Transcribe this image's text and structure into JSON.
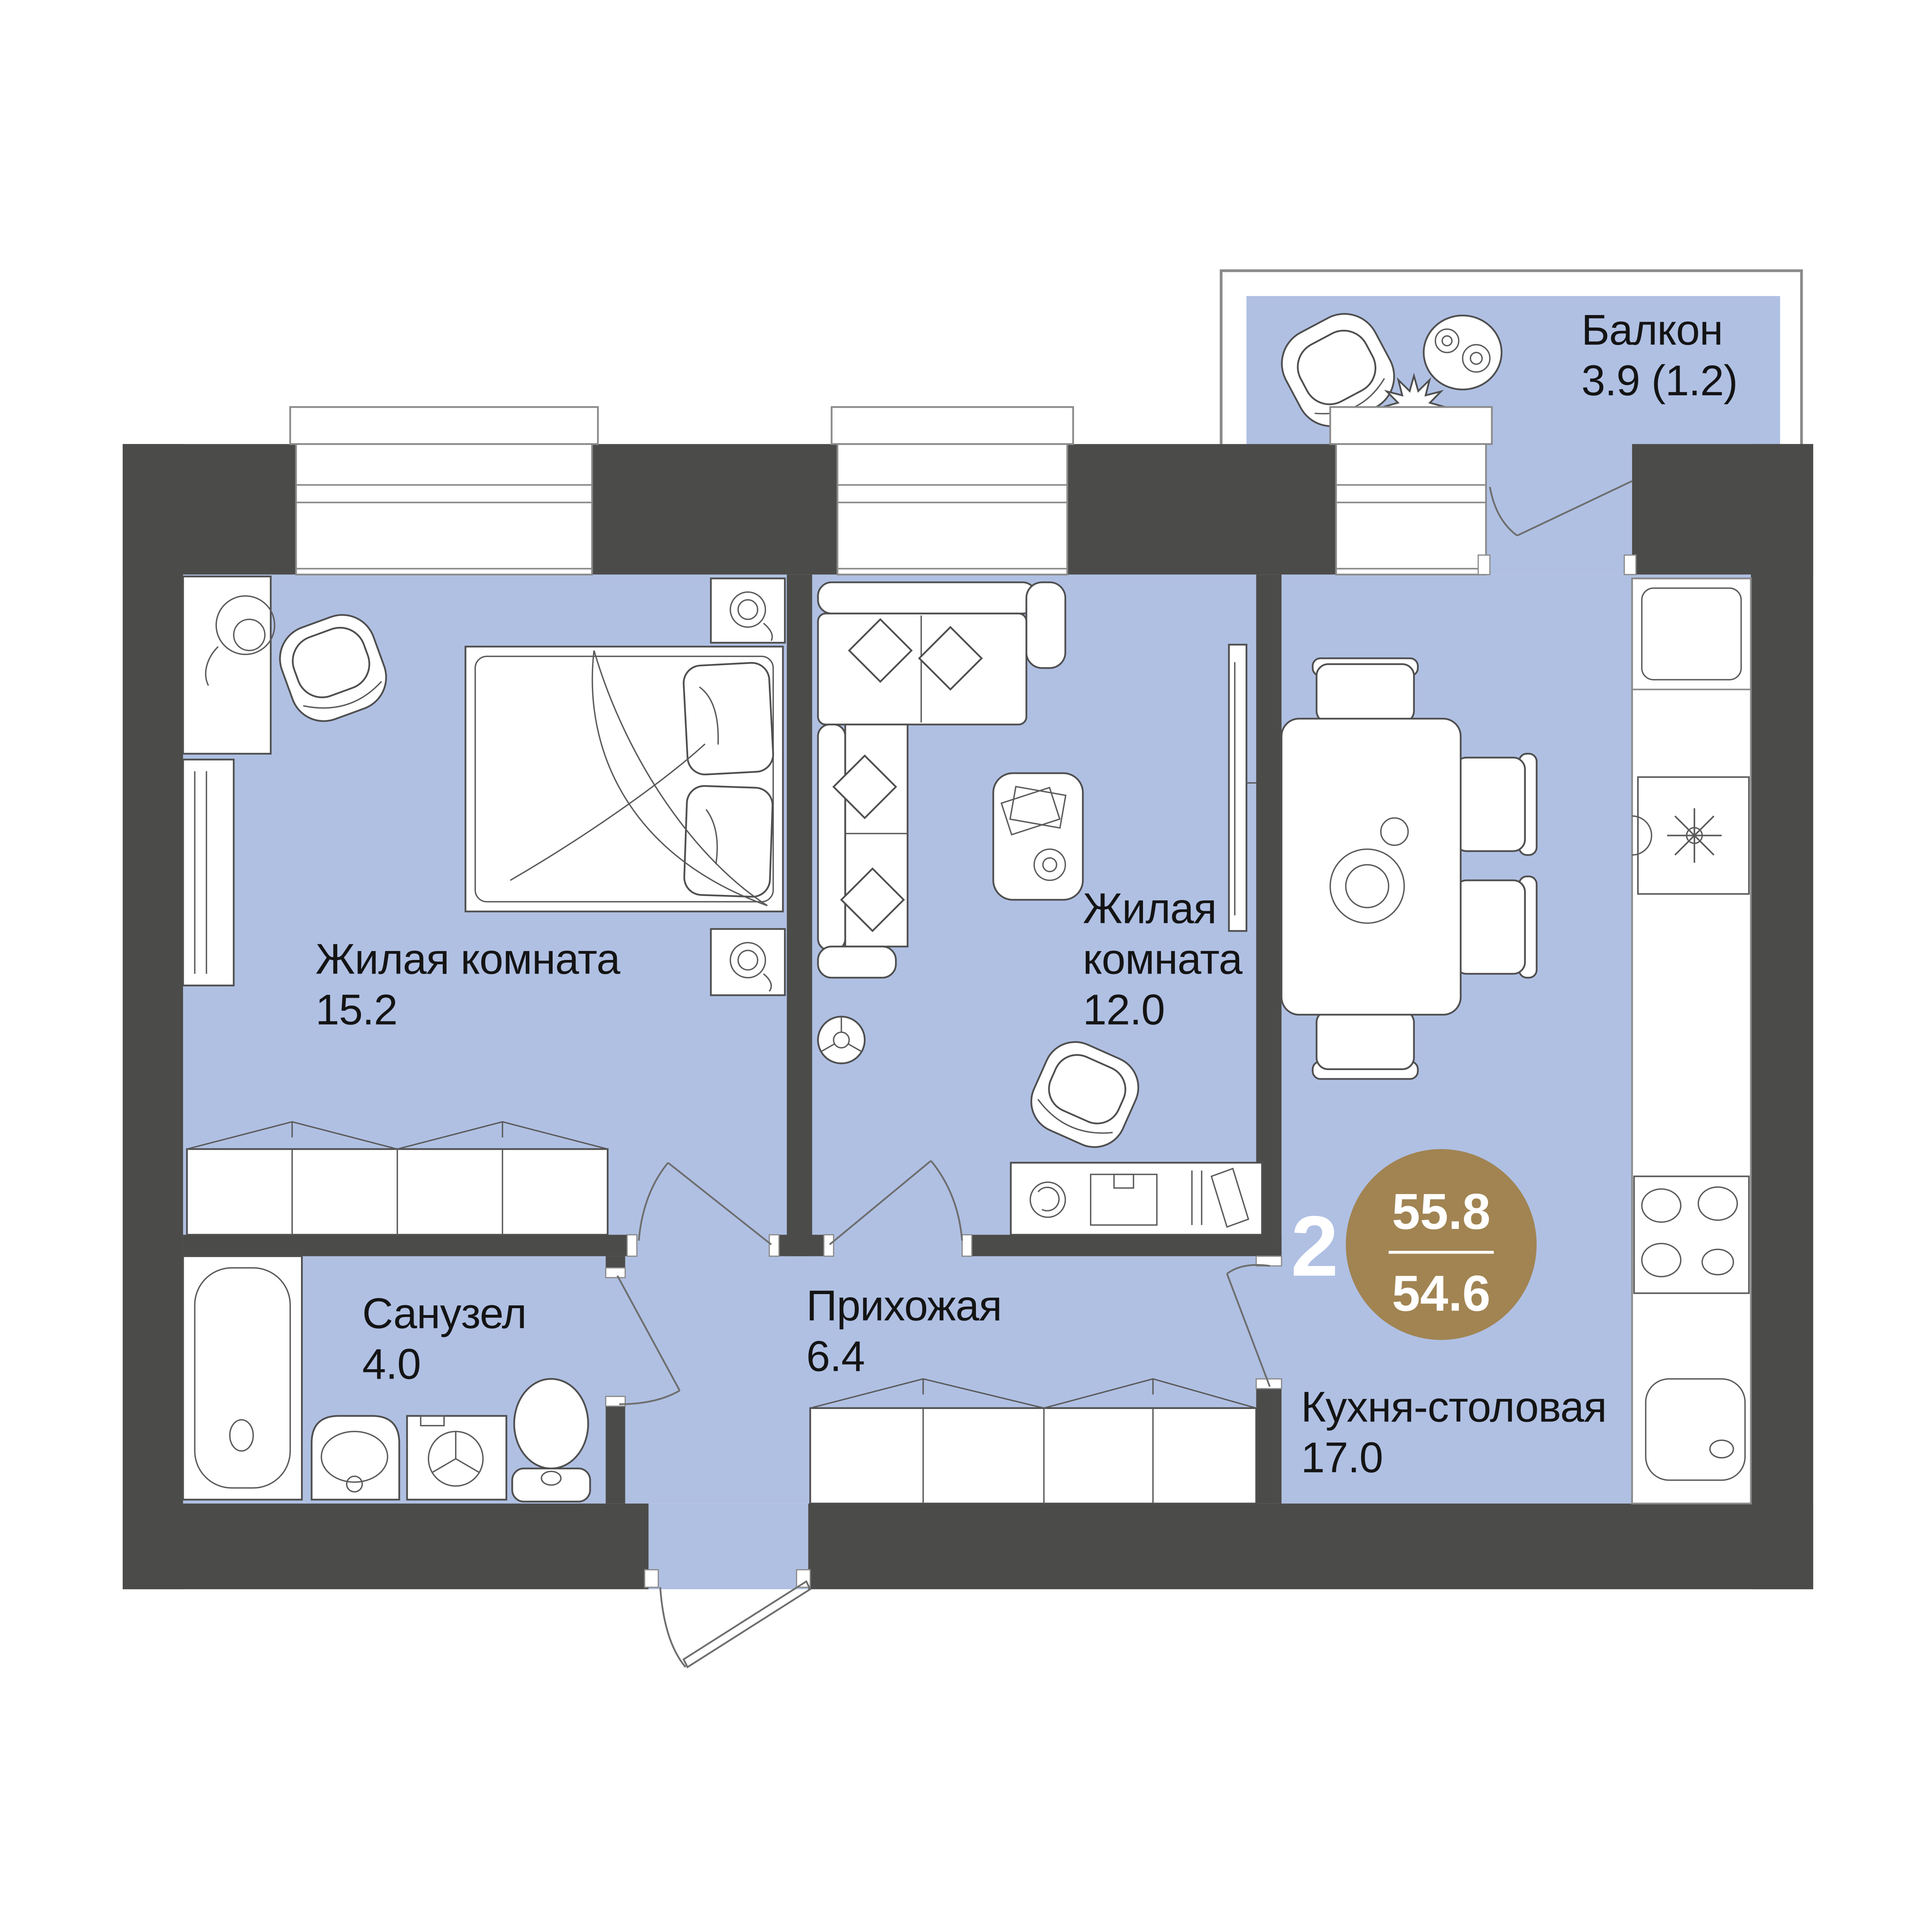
{
  "plan": {
    "type": "apartment-floorplan",
    "rooms": [
      {
        "id": "living-room-1",
        "name": "Жилая комната",
        "area": "15.2"
      },
      {
        "id": "living-room-2",
        "name_lines": [
          "Жилая",
          "комната"
        ],
        "area": "12.0"
      },
      {
        "id": "bathroom",
        "name": "Санузел",
        "area": "4.0"
      },
      {
        "id": "hallway",
        "name": "Прихожая",
        "area": "6.4"
      },
      {
        "id": "kitchen-dining",
        "name": "Кухня-столовая",
        "area": "17.0"
      },
      {
        "id": "balcony",
        "name": "Балкон",
        "area": "3.9 (1.2)"
      }
    ],
    "badge": {
      "rooms_count": "2",
      "area_total": "55.8",
      "area_living": "54.6"
    },
    "colors": {
      "floor": "#b0c0e3",
      "wall": "#4b4b49",
      "accent_gold": "#a18452",
      "text": "#141414",
      "background": "#ffffff"
    },
    "furniture_icons": [
      "bed-icon",
      "pillow-icon",
      "nightstand-lamp-icon",
      "armchair-icon",
      "plant-icon",
      "shelf-icon",
      "wardrobe-icon",
      "corner-sofa-icon",
      "coffee-table-icon",
      "tv-icon",
      "floor-lamp-icon",
      "desk-icon",
      "dining-table-icon",
      "chair-icon",
      "fridge-icon",
      "kitchen-sink-icon",
      "stove-icon",
      "counter-sink-icon",
      "bathtub-icon",
      "washbasin-icon",
      "washing-machine-icon",
      "toilet-icon",
      "balcony-chair-icon",
      "balcony-table-icon",
      "balcony-plant-icon",
      "door-swing-icon",
      "window-icon"
    ]
  }
}
